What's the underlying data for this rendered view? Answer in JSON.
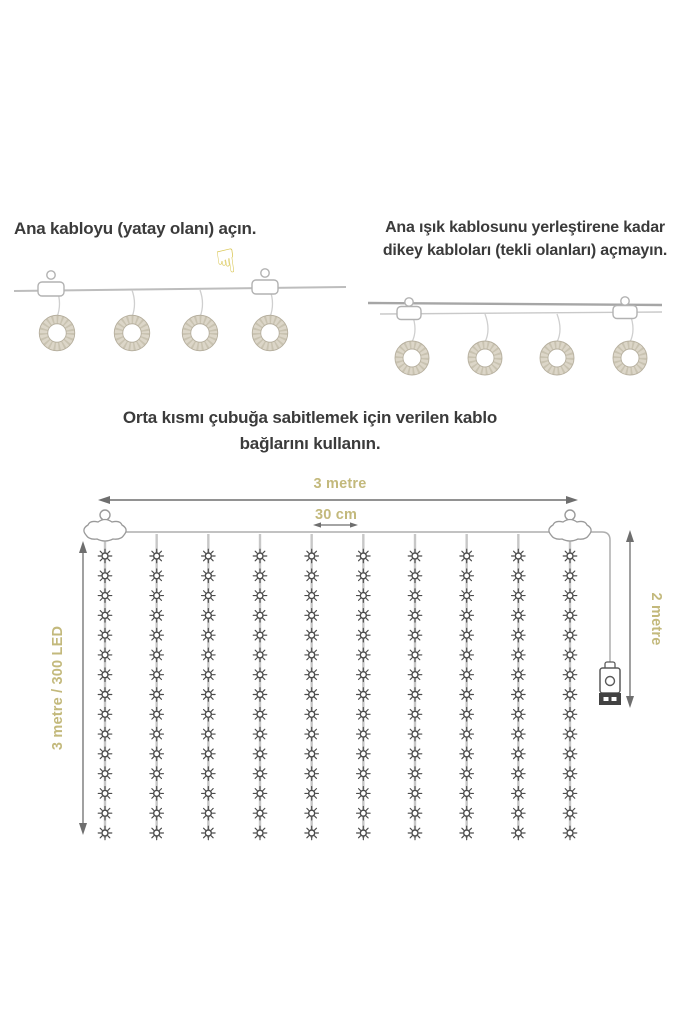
{
  "steps": {
    "step1": {
      "text": "Ana kabloyu (yatay olanı) açın.",
      "hand_icon": "☟",
      "ring_count": 4
    },
    "step2": {
      "line1": "Ana ışık kablosunu yerleştirene kadar",
      "line2": "dikey kabloları (tekli olanları) açmayın.",
      "ring_count": 4
    },
    "step3": {
      "line1": "Orta kısmı çubuğa sabitlemek için verilen kablo",
      "line2": "bağlarını kullanın."
    }
  },
  "diagram": {
    "width_label": "3 metre",
    "led_spacing_label": "30 cm",
    "drop_label": "2 metre",
    "string_label": "3 metre / 300 LED",
    "strand_count": 10,
    "leds_per_strand": 15,
    "has_usb_controller": true
  },
  "colors": {
    "text": "#3b3b3b",
    "dimension_label": "#c3b97c",
    "cable": "#b3b3b3",
    "arrow": "#6e6e6e",
    "led": "#4b4b4b",
    "ring_fill": "#dcd6c8",
    "ring_texture": "#c9c3b1",
    "usb_dark": "#424242"
  }
}
